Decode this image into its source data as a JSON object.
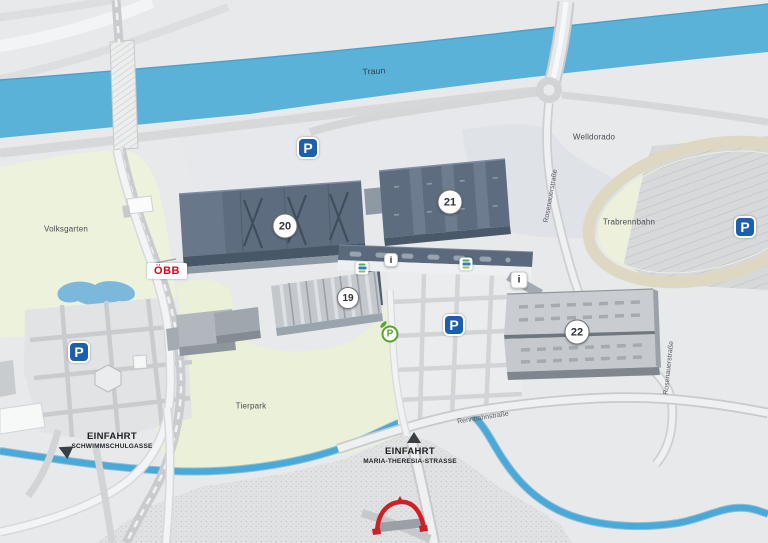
{
  "map": {
    "water": {
      "river": "Traun"
    },
    "areas": {
      "volksgarten": "Volksgarten",
      "tierpark": "Tierpark",
      "welldorado": "Welldorado",
      "trabrennbahn": "Trabrennbahn"
    },
    "streets": {
      "rosenauerstrasse": "Rosenauerstraße",
      "rennbahnstrasse": "Rennbahnstraße"
    },
    "entrances": [
      {
        "title": "EINFAHRT",
        "subtitle": "SCHWIMMSCHULGASSE"
      },
      {
        "title": "EINFAHRT",
        "subtitle": "MARIA-THERESIA-STRASSE"
      }
    ],
    "halls": [
      {
        "number": "19"
      },
      {
        "number": "20"
      },
      {
        "number": "21"
      },
      {
        "number": "22"
      }
    ],
    "icons": {
      "parking_label": "P",
      "info_label": "i",
      "green_parking_label": "P",
      "oebb_label": "ÖBB"
    },
    "colors": {
      "river_blue": "#5bb2d8",
      "stream_blue": "#49a9d8",
      "park_green": "#edf2dc",
      "hall_dark": "#5d6d7f",
      "hall_light": "#c9ccd0",
      "parking_blue": "#1c5fad",
      "green_parking": "#58a42d",
      "oebb_red": "#e2001e",
      "arch_red": "#ce2127",
      "track_tan": "#ded8c3"
    }
  }
}
